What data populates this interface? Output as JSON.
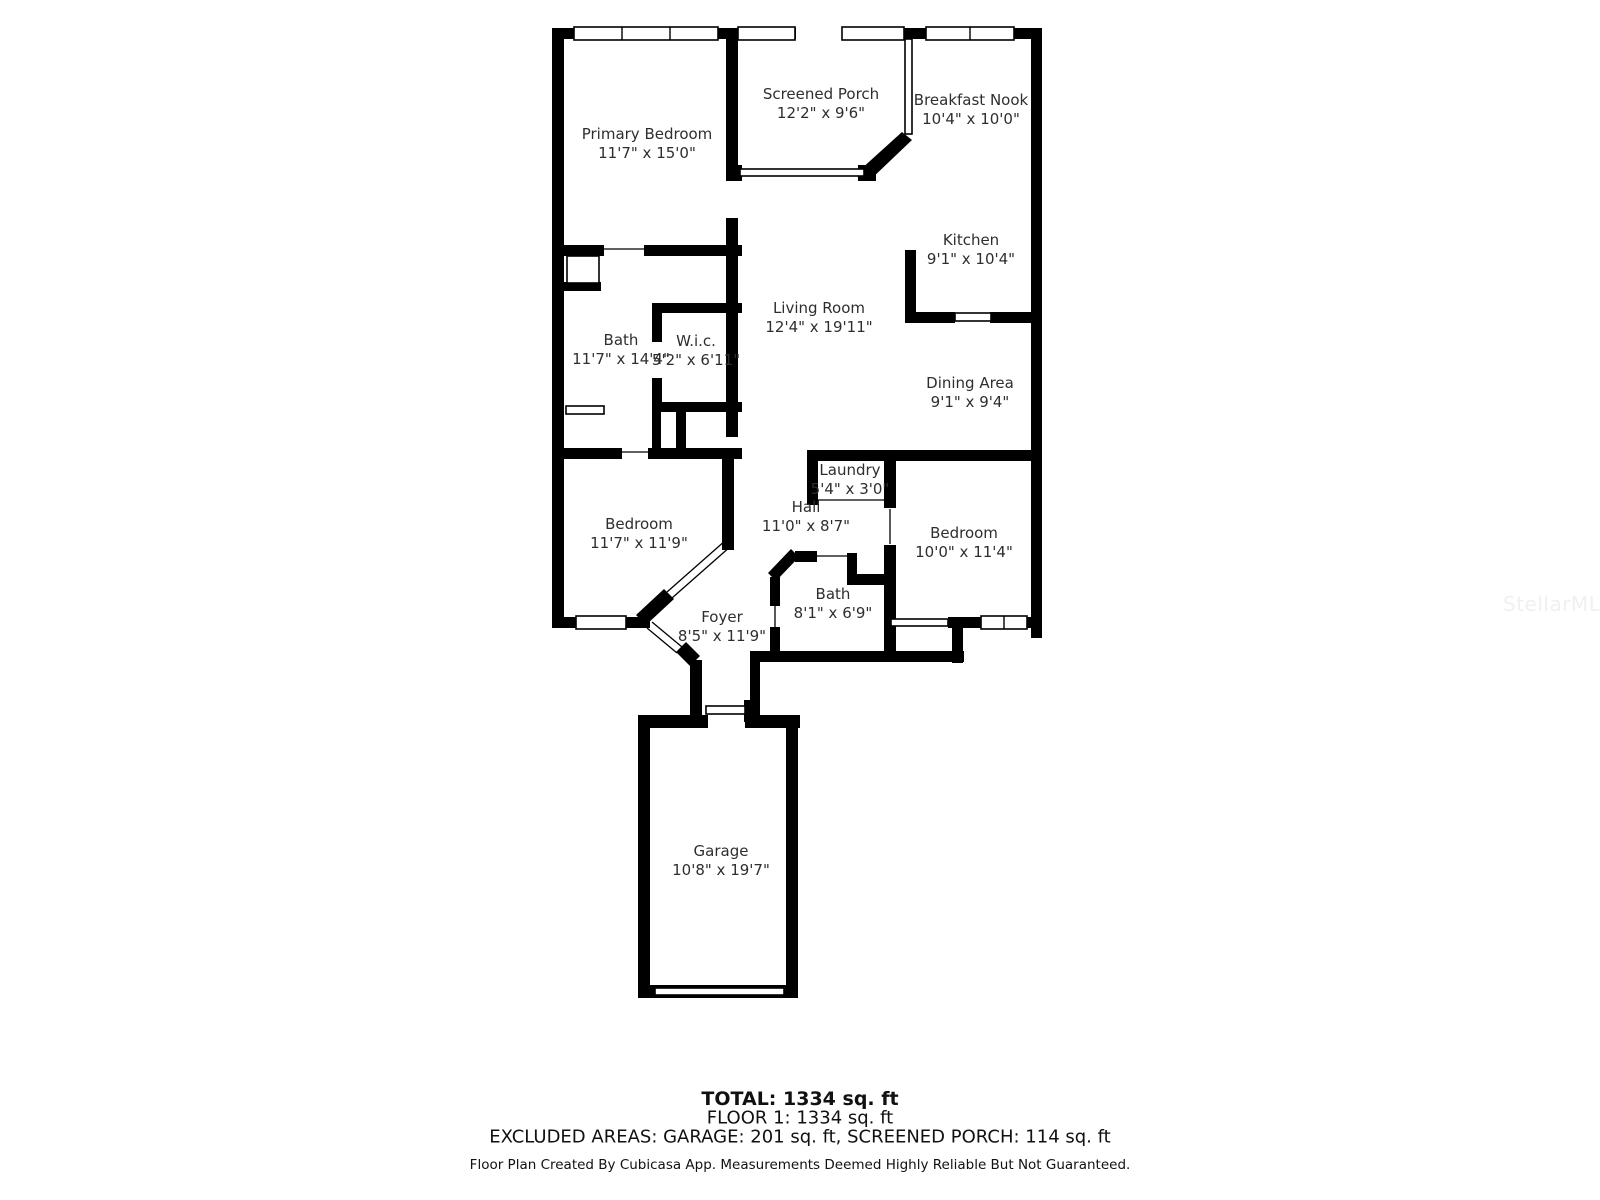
{
  "rooms": [
    {
      "id": "primary-bedroom",
      "name": "Primary Bedroom",
      "dims": "11'7\" x 15'0\""
    },
    {
      "id": "screened-porch",
      "name": "Screened Porch",
      "dims": "12'2\" x 9'6\""
    },
    {
      "id": "breakfast-nook",
      "name": "Breakfast Nook",
      "dims": "10'4\" x 10'0\""
    },
    {
      "id": "kitchen",
      "name": "Kitchen",
      "dims": "9'1\" x 10'4\""
    },
    {
      "id": "living-room",
      "name": "Living Room",
      "dims": "12'4\" x 19'11\""
    },
    {
      "id": "primary-bath",
      "name": "Bath",
      "dims": "11'7\" x 14'4\""
    },
    {
      "id": "wic",
      "name": "W.i.c.",
      "dims": "5'2\" x 6'11\""
    },
    {
      "id": "dining-area",
      "name": "Dining Area",
      "dims": "9'1\" x 9'4\""
    },
    {
      "id": "laundry",
      "name": "Laundry",
      "dims": "5'4\" x 3'0\""
    },
    {
      "id": "hall",
      "name": "Hall",
      "dims": "11'0\" x 8'7\""
    },
    {
      "id": "bedroom-left",
      "name": "Bedroom",
      "dims": "11'7\" x 11'9\""
    },
    {
      "id": "bedroom-right",
      "name": "Bedroom",
      "dims": "10'0\" x 11'4\""
    },
    {
      "id": "bath",
      "name": "Bath",
      "dims": "8'1\" x 6'9\""
    },
    {
      "id": "foyer",
      "name": "Foyer",
      "dims": "8'5\" x 11'9\""
    },
    {
      "id": "garage",
      "name": "Garage",
      "dims": "10'8\" x 19'7\""
    }
  ],
  "footer": {
    "total": "TOTAL: 1334 sq. ft",
    "floor": "FLOOR 1: 1334 sq. ft",
    "excluded": "EXCLUDED AREAS: GARAGE: 201 sq. ft, SCREENED PORCH: 114 sq. ft",
    "disclaimer": "Floor Plan Created By Cubicasa App. Measurements Deemed Highly Reliable But Not Guaranteed."
  },
  "watermark": "StellarMLS",
  "colors": {
    "wall": "#000000",
    "label_text": "#2e2e2e",
    "footer_text": "#111111",
    "watermark": "#f0f0f0",
    "background": "#ffffff"
  }
}
